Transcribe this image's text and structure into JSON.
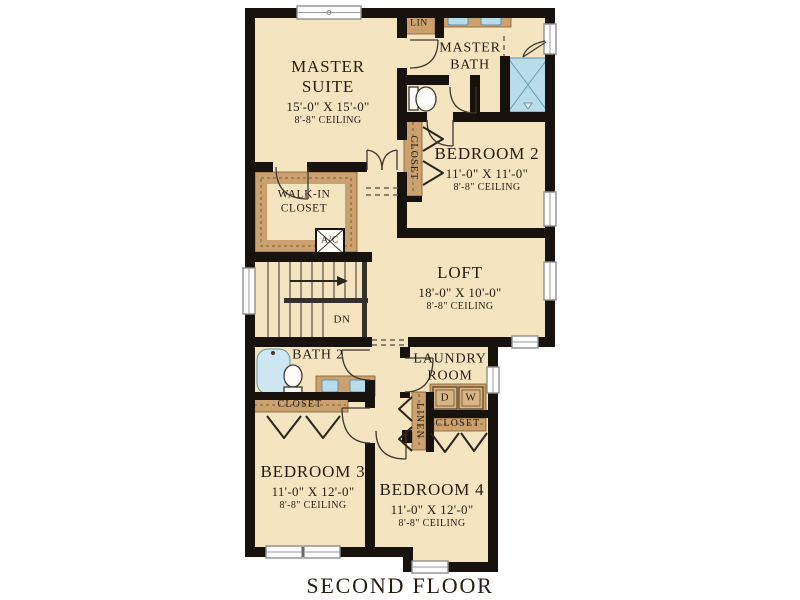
{
  "title": "SECOND FLOOR",
  "rooms": {
    "master_suite": {
      "name_line1": "MASTER",
      "name_line2": "SUITE",
      "dims": "15'-0\" X 15'-0\"",
      "ceiling": "8'-8\" CEILING"
    },
    "master_bath": {
      "name_line1": "MASTER",
      "name_line2": "BATH"
    },
    "bedroom2": {
      "name": "BEDROOM 2",
      "dims": "11'-0\" X 11'-0\"",
      "ceiling": "8'-8\" CEILING"
    },
    "loft": {
      "name": "LOFT",
      "dims": "18'-0\" X 10'-0\"",
      "ceiling": "8'-8\" CEILING"
    },
    "walk_in_closet": {
      "name_line1": "WALK-IN",
      "name_line2": "CLOSET"
    },
    "bath2": {
      "name": "BATH 2"
    },
    "laundry": {
      "name_line1": "LAUNDRY",
      "name_line2": "ROOM"
    },
    "bedroom3": {
      "name": "BEDROOM 3",
      "dims": "11'-0\" X 12'-0\"",
      "ceiling": "8'-8\" CEILING"
    },
    "bedroom4": {
      "name": "BEDROOM 4",
      "dims": "11'-0\" X 12'-0\"",
      "ceiling": "8'-8\" CEILING"
    }
  },
  "labels": {
    "lin": "LIN",
    "closet": "CLOSET",
    "linen": "LINEN",
    "ac": "A/C",
    "down": "DN",
    "dryer": "D",
    "washer": "W"
  },
  "colors": {
    "floor": "#f4e5c0",
    "wall": "#17120d",
    "wood": "#cba26f",
    "wood_edge": "#7d5d31",
    "blue": "#b9dcea",
    "blue_edge": "#5f93a8",
    "ink": "#261c10"
  }
}
